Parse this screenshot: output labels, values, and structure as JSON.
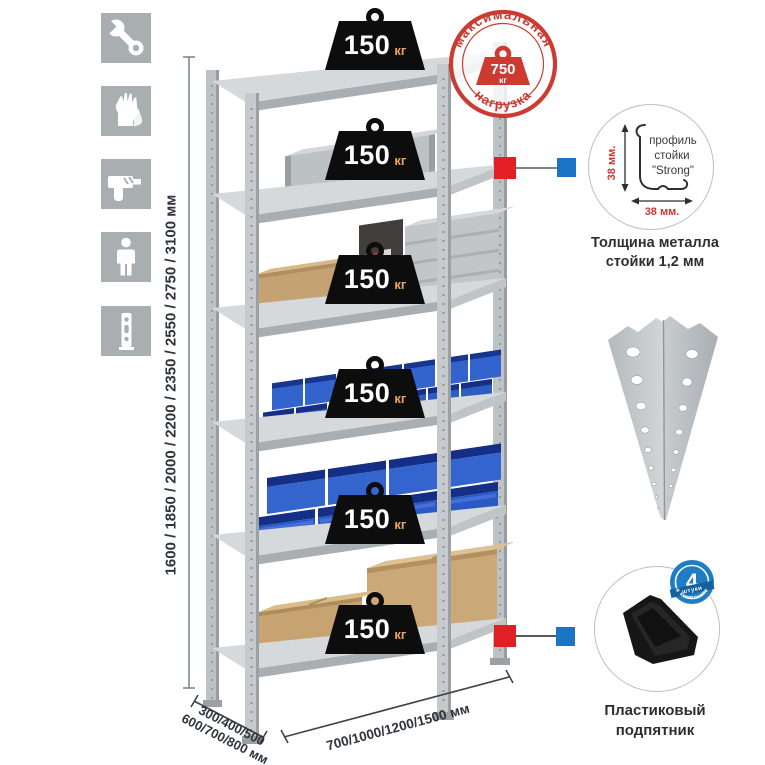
{
  "stamp": {
    "arc_top": "максимальная",
    "arc_bottom": "нагрузка",
    "value": "750",
    "unit": "кг"
  },
  "badges": [
    {
      "value": "150",
      "unit": "кг"
    },
    {
      "value": "150",
      "unit": "кг"
    },
    {
      "value": "150",
      "unit": "кг"
    },
    {
      "value": "150",
      "unit": "кг"
    },
    {
      "value": "150",
      "unit": "кг"
    },
    {
      "value": "150",
      "unit": "кг"
    }
  ],
  "dimensions": {
    "height": "1600 / 1850 / 2000 / 2200 / 2350 / 2550 / 2750 / 3100 мм",
    "depth_line1": "300/400/500",
    "depth_line2": "600/700/800 мм",
    "width": "700/1000/1200/1500 мм"
  },
  "profile_callout": {
    "text_line1": "профиль",
    "text_line2": "стойки",
    "text_line3": "\"Strong\"",
    "dim_vertical": "38 мм.",
    "dim_horizontal": "38 мм.",
    "caption_line1": "Толщина металла",
    "caption_line2": "стойки 1,2 мм"
  },
  "foot_callout": {
    "badge_value": "4",
    "badge_ribbon": "штуки",
    "badge_arc": "в комплекте",
    "caption_line1": "Пластиковый",
    "caption_line2": "подпятник"
  },
  "icons": {
    "list": [
      "wrench",
      "gloves",
      "drill",
      "person",
      "rack-post"
    ]
  },
  "colors": {
    "stamp_red": "#cd3a31",
    "connector_red": "#e11f25",
    "connector_blue": "#1b74c5",
    "bin_blue": "#2d5cc3",
    "metal_gray": "#c6cacd",
    "badge_black": "#0d0d0d",
    "kg_orange": "#eda45f",
    "icon_gray": "#a9aeb1"
  }
}
